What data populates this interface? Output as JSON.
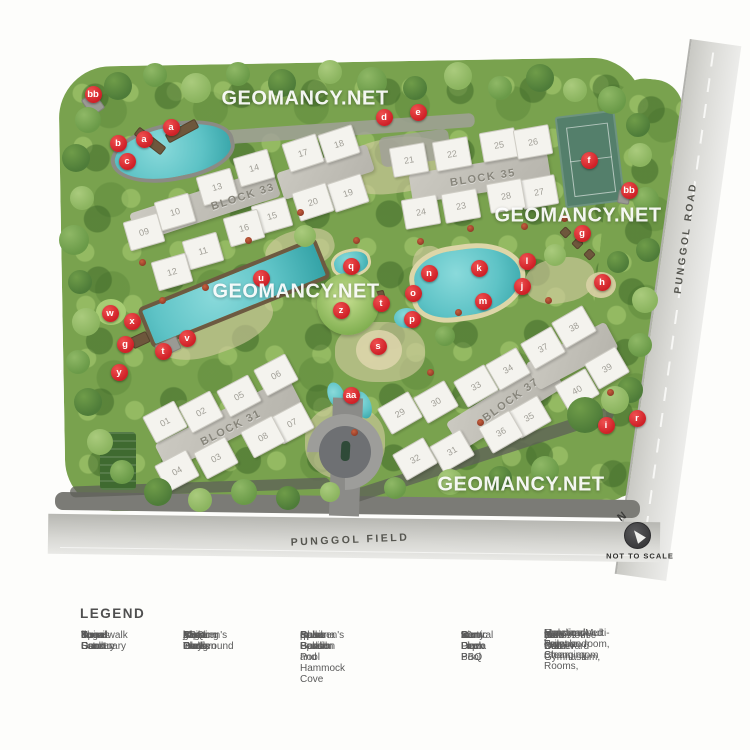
{
  "watermark": {
    "text": "GEOMANCY.NET",
    "positions": [
      {
        "x": 305,
        "y": 99
      },
      {
        "x": 578,
        "y": 216
      },
      {
        "x": 296,
        "y": 292
      },
      {
        "x": 521,
        "y": 485
      }
    ]
  },
  "map": {
    "colors": {
      "marker_red": "#cf2027",
      "water": "#5ec3c6",
      "court_green": "#547f6b"
    },
    "roads": {
      "right_label": "PUNGGOL ROAD",
      "bottom_label": "PUNGGOL FIELD"
    },
    "north": {
      "letter": "N",
      "note": "NOT TO SCALE"
    },
    "blocks": [
      {
        "label": "BLOCK 33",
        "x": 243,
        "y": 197,
        "rot": -18
      },
      {
        "label": "BLOCK 35",
        "x": 483,
        "y": 178,
        "rot": -9
      },
      {
        "label": "BLOCK 31",
        "x": 231,
        "y": 428,
        "rot": -27
      },
      {
        "label": "BLOCK 37",
        "x": 511,
        "y": 400,
        "rot": -36
      }
    ],
    "cores": [
      {
        "x": 205,
        "y": 205,
        "w": 150,
        "h": 30,
        "rot": -18
      },
      {
        "x": 325,
        "y": 172,
        "w": 95,
        "h": 28,
        "rot": -18
      },
      {
        "x": 480,
        "y": 178,
        "w": 140,
        "h": 30,
        "rot": -9
      },
      {
        "x": 228,
        "y": 424,
        "w": 150,
        "h": 30,
        "rot": -27
      },
      {
        "x": 505,
        "y": 405,
        "w": 120,
        "h": 32,
        "rot": -32
      },
      {
        "x": 572,
        "y": 356,
        "w": 90,
        "h": 30,
        "rot": -28
      }
    ],
    "units": [
      {
        "n": "01",
        "x": 165,
        "y": 422,
        "rot": -28
      },
      {
        "n": "02",
        "x": 201,
        "y": 412,
        "rot": -28
      },
      {
        "n": "03",
        "x": 216,
        "y": 458,
        "rot": -28
      },
      {
        "n": "04",
        "x": 177,
        "y": 471,
        "rot": -28
      },
      {
        "n": "05",
        "x": 239,
        "y": 396,
        "rot": -28
      },
      {
        "n": "06",
        "x": 276,
        "y": 375,
        "rot": -28
      },
      {
        "n": "07",
        "x": 292,
        "y": 423,
        "rot": -28
      },
      {
        "n": "08",
        "x": 263,
        "y": 437,
        "rot": -28
      },
      {
        "n": "09",
        "x": 144,
        "y": 232,
        "rot": -16
      },
      {
        "n": "10",
        "x": 175,
        "y": 212,
        "rot": -16
      },
      {
        "n": "11",
        "x": 203,
        "y": 251,
        "rot": -16
      },
      {
        "n": "12",
        "x": 172,
        "y": 272,
        "rot": -16
      },
      {
        "n": "13",
        "x": 217,
        "y": 187,
        "rot": -16
      },
      {
        "n": "14",
        "x": 254,
        "y": 168,
        "rot": -16
      },
      {
        "n": "15",
        "x": 272,
        "y": 216,
        "rot": -16
      },
      {
        "n": "16",
        "x": 244,
        "y": 228,
        "rot": -16
      },
      {
        "n": "17",
        "x": 303,
        "y": 153,
        "rot": -18
      },
      {
        "n": "18",
        "x": 339,
        "y": 144,
        "rot": -18
      },
      {
        "n": "19",
        "x": 348,
        "y": 193,
        "rot": -18
      },
      {
        "n": "20",
        "x": 313,
        "y": 202,
        "rot": -18
      },
      {
        "n": "21",
        "x": 409,
        "y": 160,
        "rot": -10
      },
      {
        "n": "22",
        "x": 452,
        "y": 154,
        "rot": -10
      },
      {
        "n": "23",
        "x": 461,
        "y": 206,
        "rot": -10
      },
      {
        "n": "24",
        "x": 421,
        "y": 212,
        "rot": -10
      },
      {
        "n": "25",
        "x": 499,
        "y": 145,
        "rot": -10
      },
      {
        "n": "26",
        "x": 533,
        "y": 142,
        "rot": -10
      },
      {
        "n": "27",
        "x": 539,
        "y": 192,
        "rot": -10
      },
      {
        "n": "28",
        "x": 506,
        "y": 196,
        "rot": -10
      },
      {
        "n": "29",
        "x": 400,
        "y": 413,
        "rot": -30
      },
      {
        "n": "30",
        "x": 436,
        "y": 402,
        "rot": -30
      },
      {
        "n": "31",
        "x": 452,
        "y": 451,
        "rot": -30
      },
      {
        "n": "32",
        "x": 415,
        "y": 459,
        "rot": -30
      },
      {
        "n": "33",
        "x": 476,
        "y": 386,
        "rot": -30
      },
      {
        "n": "34",
        "x": 508,
        "y": 369,
        "rot": -30
      },
      {
        "n": "35",
        "x": 529,
        "y": 417,
        "rot": -30
      },
      {
        "n": "36",
        "x": 501,
        "y": 432,
        "rot": -30
      },
      {
        "n": "37",
        "x": 543,
        "y": 348,
        "rot": -30
      },
      {
        "n": "38",
        "x": 574,
        "y": 327,
        "rot": -30
      },
      {
        "n": "39",
        "x": 607,
        "y": 368,
        "rot": -30
      },
      {
        "n": "40",
        "x": 577,
        "y": 390,
        "rot": -30
      }
    ],
    "markers": [
      {
        "t": "bb",
        "x": 93,
        "y": 94
      },
      {
        "t": "b",
        "x": 118,
        "y": 143
      },
      {
        "t": "a",
        "x": 144,
        "y": 139
      },
      {
        "t": "a",
        "x": 171,
        "y": 127
      },
      {
        "t": "c",
        "x": 127,
        "y": 161
      },
      {
        "t": "d",
        "x": 384,
        "y": 117
      },
      {
        "t": "e",
        "x": 418,
        "y": 112
      },
      {
        "t": "f",
        "x": 589,
        "y": 160
      },
      {
        "t": "bb",
        "x": 629,
        "y": 190
      },
      {
        "t": "g",
        "x": 582,
        "y": 233
      },
      {
        "t": "h",
        "x": 602,
        "y": 282
      },
      {
        "t": "l",
        "x": 527,
        "y": 261
      },
      {
        "t": "k",
        "x": 479,
        "y": 268
      },
      {
        "t": "n",
        "x": 429,
        "y": 273
      },
      {
        "t": "o",
        "x": 413,
        "y": 293
      },
      {
        "t": "j",
        "x": 522,
        "y": 286
      },
      {
        "t": "m",
        "x": 483,
        "y": 301
      },
      {
        "t": "p",
        "x": 412,
        "y": 319
      },
      {
        "t": "q",
        "x": 351,
        "y": 266
      },
      {
        "t": "u",
        "x": 261,
        "y": 278
      },
      {
        "t": "z",
        "x": 341,
        "y": 310
      },
      {
        "t": "t",
        "x": 381,
        "y": 303
      },
      {
        "t": "s",
        "x": 378,
        "y": 346
      },
      {
        "t": "v",
        "x": 187,
        "y": 338
      },
      {
        "t": "x",
        "x": 132,
        "y": 321
      },
      {
        "t": "w",
        "x": 110,
        "y": 313
      },
      {
        "t": "g",
        "x": 125,
        "y": 344
      },
      {
        "t": "t",
        "x": 163,
        "y": 351
      },
      {
        "t": "y",
        "x": 119,
        "y": 372
      },
      {
        "t": "aa",
        "x": 351,
        "y": 395
      },
      {
        "t": "i",
        "x": 606,
        "y": 425
      },
      {
        "t": "r",
        "x": 637,
        "y": 418
      }
    ],
    "patches": [
      {
        "x": 395,
        "y": 165,
        "w": 110,
        "h": 55,
        "rot": -8
      },
      {
        "x": 380,
        "y": 352,
        "w": 90,
        "h": 60,
        "rot": 0
      },
      {
        "x": 215,
        "y": 325,
        "w": 120,
        "h": 55,
        "rot": -20
      },
      {
        "x": 560,
        "y": 280,
        "w": 70,
        "h": 45,
        "rot": -10
      },
      {
        "x": 300,
        "y": 250,
        "w": 70,
        "h": 40,
        "rot": -15
      },
      {
        "x": 345,
        "y": 442,
        "w": 80,
        "h": 74,
        "rot": 0
      },
      {
        "x": 430,
        "y": 268,
        "w": 34,
        "h": 44,
        "rot": -10
      }
    ],
    "bands": [
      {
        "x": 330,
        "y": 130,
        "w": 290,
        "h": 14,
        "rot": -4,
        "dark": false
      },
      {
        "x": 415,
        "y": 148,
        "w": 70,
        "h": 30,
        "rot": -8,
        "dark": false
      },
      {
        "x": 200,
        "y": 487,
        "w": 260,
        "h": 11,
        "rot": -2,
        "dark": true
      },
      {
        "x": 480,
        "y": 455,
        "w": 280,
        "h": 13,
        "rot": -18,
        "dark": true
      }
    ],
    "decks": [
      {
        "x": 150,
        "y": 141,
        "w": 34,
        "h": 10,
        "rot": 38,
        "c": "brown"
      },
      {
        "x": 182,
        "y": 131,
        "w": 34,
        "h": 10,
        "rot": -28,
        "c": "brown"
      },
      {
        "x": 372,
        "y": 301,
        "w": 28,
        "h": 16,
        "rot": -15,
        "c": "brown"
      },
      {
        "x": 168,
        "y": 347,
        "w": 24,
        "h": 14,
        "rot": -25,
        "c": "gray"
      },
      {
        "x": 565,
        "y": 232,
        "w": 9,
        "h": 9,
        "rot": 45,
        "c": "brown"
      },
      {
        "x": 577,
        "y": 243,
        "w": 9,
        "h": 9,
        "rot": 45,
        "c": "brown"
      },
      {
        "x": 589,
        "y": 254,
        "w": 9,
        "h": 9,
        "rot": 45,
        "c": "brown"
      },
      {
        "x": 140,
        "y": 340,
        "w": 18,
        "h": 12,
        "rot": -25,
        "c": "brown"
      },
      {
        "x": 93,
        "y": 104,
        "w": 16,
        "h": 20,
        "rot": -35,
        "c": "gray"
      },
      {
        "x": 624,
        "y": 197,
        "w": 12,
        "h": 14,
        "rot": 10,
        "c": "gray"
      }
    ],
    "trees": [
      {
        "x": 118,
        "y": 86,
        "r": 14,
        "c": 0
      },
      {
        "x": 155,
        "y": 75,
        "r": 12,
        "c": 1
      },
      {
        "x": 196,
        "y": 88,
        "r": 15,
        "c": 2
      },
      {
        "x": 238,
        "y": 74,
        "r": 12,
        "c": 1
      },
      {
        "x": 282,
        "y": 83,
        "r": 14,
        "c": 0
      },
      {
        "x": 330,
        "y": 72,
        "r": 12,
        "c": 2
      },
      {
        "x": 372,
        "y": 82,
        "r": 15,
        "c": 1
      },
      {
        "x": 415,
        "y": 88,
        "r": 12,
        "c": 0
      },
      {
        "x": 458,
        "y": 76,
        "r": 14,
        "c": 2
      },
      {
        "x": 500,
        "y": 88,
        "r": 12,
        "c": 1
      },
      {
        "x": 540,
        "y": 78,
        "r": 14,
        "c": 0
      },
      {
        "x": 575,
        "y": 90,
        "r": 12,
        "c": 2
      },
      {
        "x": 612,
        "y": 100,
        "r": 14,
        "c": 1
      },
      {
        "x": 638,
        "y": 125,
        "r": 12,
        "c": 0
      },
      {
        "x": 88,
        "y": 120,
        "r": 13,
        "c": 1
      },
      {
        "x": 76,
        "y": 158,
        "r": 14,
        "c": 0
      },
      {
        "x": 82,
        "y": 198,
        "r": 12,
        "c": 2
      },
      {
        "x": 74,
        "y": 240,
        "r": 15,
        "c": 1
      },
      {
        "x": 80,
        "y": 282,
        "r": 12,
        "c": 0
      },
      {
        "x": 86,
        "y": 322,
        "r": 14,
        "c": 2
      },
      {
        "x": 78,
        "y": 362,
        "r": 12,
        "c": 1
      },
      {
        "x": 88,
        "y": 402,
        "r": 14,
        "c": 0
      },
      {
        "x": 100,
        "y": 442,
        "r": 13,
        "c": 2
      },
      {
        "x": 122,
        "y": 472,
        "r": 12,
        "c": 1
      },
      {
        "x": 158,
        "y": 492,
        "r": 14,
        "c": 0
      },
      {
        "x": 200,
        "y": 500,
        "r": 12,
        "c": 2
      },
      {
        "x": 244,
        "y": 492,
        "r": 13,
        "c": 1
      },
      {
        "x": 288,
        "y": 498,
        "r": 12,
        "c": 0
      },
      {
        "x": 330,
        "y": 492,
        "r": 10,
        "c": 2
      },
      {
        "x": 640,
        "y": 155,
        "r": 12,
        "c": 2
      },
      {
        "x": 646,
        "y": 200,
        "r": 13,
        "c": 1
      },
      {
        "x": 648,
        "y": 250,
        "r": 12,
        "c": 0
      },
      {
        "x": 645,
        "y": 300,
        "r": 13,
        "c": 2
      },
      {
        "x": 640,
        "y": 345,
        "r": 12,
        "c": 1
      },
      {
        "x": 630,
        "y": 390,
        "r": 13,
        "c": 0
      },
      {
        "x": 585,
        "y": 415,
        "r": 18,
        "c": 0
      },
      {
        "x": 615,
        "y": 400,
        "r": 14,
        "c": 2
      },
      {
        "x": 545,
        "y": 470,
        "r": 14,
        "c": 1
      },
      {
        "x": 500,
        "y": 478,
        "r": 12,
        "c": 0
      },
      {
        "x": 450,
        "y": 482,
        "r": 13,
        "c": 2
      },
      {
        "x": 395,
        "y": 488,
        "r": 11,
        "c": 1
      },
      {
        "x": 305,
        "y": 236,
        "r": 11,
        "c": 2
      },
      {
        "x": 445,
        "y": 336,
        "r": 10,
        "c": 1
      },
      {
        "x": 555,
        "y": 255,
        "r": 11,
        "c": 2
      },
      {
        "x": 618,
        "y": 262,
        "r": 11,
        "c": 0
      }
    ],
    "shrubs": [
      {
        "x": 248,
        "y": 240
      },
      {
        "x": 205,
        "y": 287
      },
      {
        "x": 300,
        "y": 212
      },
      {
        "x": 356,
        "y": 240
      },
      {
        "x": 420,
        "y": 241
      },
      {
        "x": 470,
        "y": 228
      },
      {
        "x": 524,
        "y": 226
      },
      {
        "x": 564,
        "y": 218
      },
      {
        "x": 458,
        "y": 312
      },
      {
        "x": 548,
        "y": 300
      },
      {
        "x": 430,
        "y": 372
      },
      {
        "x": 354,
        "y": 432
      },
      {
        "x": 480,
        "y": 422
      },
      {
        "x": 610,
        "y": 392
      },
      {
        "x": 162,
        "y": 300
      },
      {
        "x": 142,
        "y": 262
      }
    ]
  },
  "legend": {
    "title": "LEGEND",
    "columns": [
      {
        "x": 1,
        "items": [
          {
            "key": "a.",
            "label": "Spiral Sanctuary"
          },
          {
            "key": "b.",
            "label": "Boardwalk"
          },
          {
            "key": "c.",
            "label": "The Estuary"
          },
          {
            "key": "d.",
            "label": "Ilume Garden"
          },
          {
            "key": "e.",
            "label": "Yoga Deck"
          },
          {
            "key": "f.",
            "label": "Tennis Court"
          }
        ]
      },
      {
        "x": 103,
        "items": [
          {
            "key": "g.",
            "label": "BBQ Trellis"
          },
          {
            "key": "h.",
            "label": "Children's Playground"
          },
          {
            "key": "i.",
            "label": "Maze Garden"
          },
          {
            "key": "j.",
            "label": "Floating Islets"
          },
          {
            "key": "k.",
            "label": "Lagoon Pool"
          },
          {
            "key": "l.",
            "label": "Aqua Deck"
          }
        ]
      },
      {
        "x": 220,
        "items": [
          {
            "key": "m.",
            "label": "Cabana"
          },
          {
            "key": "n.",
            "label": "Palm Beach and Hammock Cove"
          },
          {
            "key": "o.",
            "label": "Oasis Pavilion"
          },
          {
            "key": "p.",
            "label": "Children's Splash Pool"
          },
          {
            "key": "q.",
            "label": "Spa Pods"
          },
          {
            "key": "r.",
            "label": "Spice Garden"
          }
        ]
      },
      {
        "x": 381,
        "items": [
          {
            "key": "s.",
            "label": "Central Plaza"
          },
          {
            "key": "t.",
            "label": "Party Deck"
          },
          {
            "key": "u.",
            "label": "50m Lap Pool"
          },
          {
            "key": "v.",
            "label": "Sun Deck"
          },
          {
            "key": "w.",
            "label": "Picnic Lawn"
          },
          {
            "key": "x.",
            "label": "Bon Fire BBQ"
          }
        ]
      },
      {
        "x": 464,
        "items": [
          {
            "key": "y.",
            "label": "Fitness Corner"
          },
          {
            "key": "z.",
            "label": "Club House with Gymnasium,"
          },
          {
            "key": "",
            "label": "Function/Multi-Purpose room,",
            "cont": true
          },
          {
            "key": "",
            "label": "Male and Female Changing Rooms,",
            "cont": true
          },
          {
            "key": "",
            "label": "Handicapped Toilet and Steam room",
            "cont": true
          },
          {
            "key": "aa.",
            "label": "Palm Boulevard"
          },
          {
            "key": "bb.",
            "label": "Side Gate"
          }
        ]
      }
    ]
  }
}
